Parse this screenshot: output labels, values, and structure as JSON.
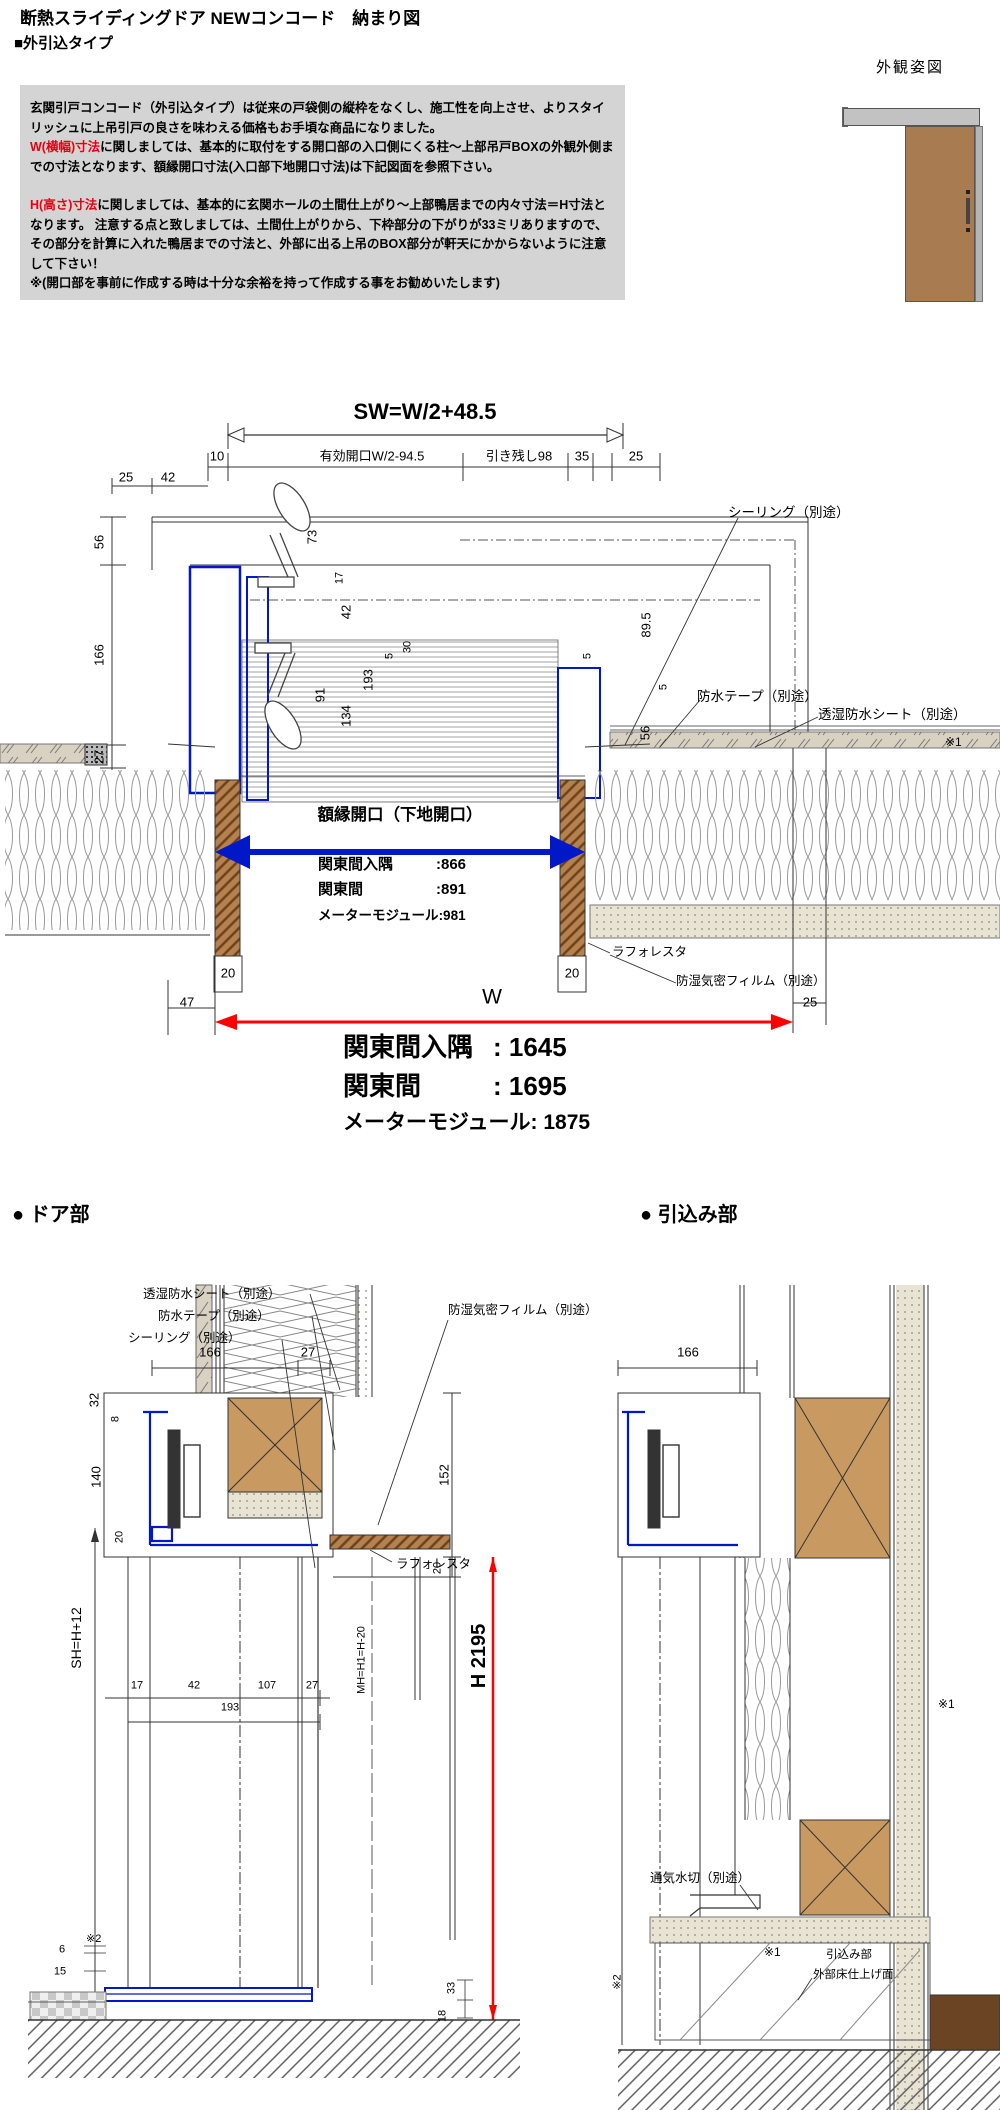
{
  "colors": {
    "info_box_bg": "#d4d4d4",
    "red_text": "#e60012",
    "dim_red": "#ff0000",
    "frame_blue": "#0018c8",
    "wood_brown": "#b5824f",
    "wall_tan": "#d9d2c2"
  },
  "page": {
    "title": "断熱スライディングドア NEWコンコード　納まり図",
    "subtitle": "■外引込タイプ"
  },
  "info_box": {
    "p1": "玄関引戸コンコード（外引込タイプ）は従来の戸袋側の縦枠をなくし、施工性を向上させ、よりスタイリッシュに上吊引戸の良さを味わえる価格もお手頃な商品になりました。",
    "p2_red": "W(横幅)寸法",
    "p2_rest": "に関しましては、基本的に取付をする開口部の入口側にくる柱～上部吊戸BOXの外観外側までの寸法となります、額縁開口寸法(入口部下地開口寸法)は下記図面を参照下さい。",
    "p3_red": "H(高さ)寸法",
    "p3_rest": "に関しましては、基本的に玄関ホールの土間仕上がり～上部鴨居までの内々寸法＝H寸法となります。 注意する点と致しましては、土間仕上がりから、下枠部分の下がりが33ミリありますので、その部分を計算に入れた鴨居までの寸法と、外部に出る上吊のBOX部分が軒天にかからないように注意して下さい！",
    "p4": "※(開口部を事前に作成する時は十分な余裕を持って作成する事をお勧めいたします)"
  },
  "appearance": {
    "label": "外観姿図"
  },
  "plan": {
    "sw": "SW=W/2+48.5",
    "dims": {
      "d10": "10",
      "eff": "有効開口W/2-94.5",
      "hiki": "引き残し98",
      "d35": "35",
      "d25a": "25",
      "d25b": "25",
      "d42": "42",
      "d56": "56",
      "d166": "166",
      "d27": "27",
      "d73": "73",
      "d17": "17",
      "d42i": "42",
      "d193": "193",
      "d91": "91",
      "d134": "134",
      "d30": "30",
      "d5a": "5",
      "d5b": "5",
      "d89": "89.5",
      "d5r": "5",
      "d56r": "56",
      "d20l": "20",
      "d20r": "20",
      "d47": "47",
      "d25w": "25",
      "w": "W"
    },
    "callouts": {
      "sealing": "シーリング（別途）",
      "tape": "防水テープ（別途）",
      "sheet": "透湿防水シート（別途）",
      "note1": "※1",
      "laforesta": "ラフォレスタ",
      "film": "防湿気密フィルム（別途）"
    },
    "opening": "額縁開口（下地開口）",
    "table": [
      {
        "label": "関東間入隅",
        "value": ":866"
      },
      {
        "label": "関東間",
        "value": ":891"
      },
      {
        "label": "メーターモジュール",
        "value": ":981"
      }
    ],
    "summary": [
      {
        "label": "関東間入隅",
        "value": ": 1645"
      },
      {
        "label": "関東間",
        "value": ": 1695"
      },
      {
        "label": "メーターモジュール",
        "value": ": 1875"
      }
    ]
  },
  "door": {
    "heading": "● ドア部",
    "callouts": {
      "sheet": "透湿防水シート（別途）",
      "tape": "防水テープ（別途）",
      "sealing": "シーリング（別途）",
      "film": "防湿気密フィルム（別途）",
      "laforesta": "ラフォレスタ"
    },
    "dims": {
      "d166": "166",
      "d27": "27",
      "d32": "32",
      "d8": "8",
      "d140": "140",
      "d20": "20",
      "sh": "SH=H+12",
      "d152": "152",
      "d20b": "20",
      "h": "H 2195",
      "mh": "MH=H1=H-20",
      "d17": "17",
      "d42": "42",
      "d107": "107",
      "d27b": "27",
      "d193": "193",
      "d6": "6",
      "d15": "15",
      "d33": "33",
      "d18": "18",
      "note2": "※2"
    }
  },
  "pullin": {
    "heading": "● 引込み部",
    "dims": {
      "d166": "166"
    },
    "callouts": {
      "note1a": "※1",
      "mizukiri": "通気水切（別途）",
      "note1b": "※1",
      "hikikomi": "引込み部",
      "floor": "外部床仕上げ面",
      "note2": "※2"
    }
  }
}
